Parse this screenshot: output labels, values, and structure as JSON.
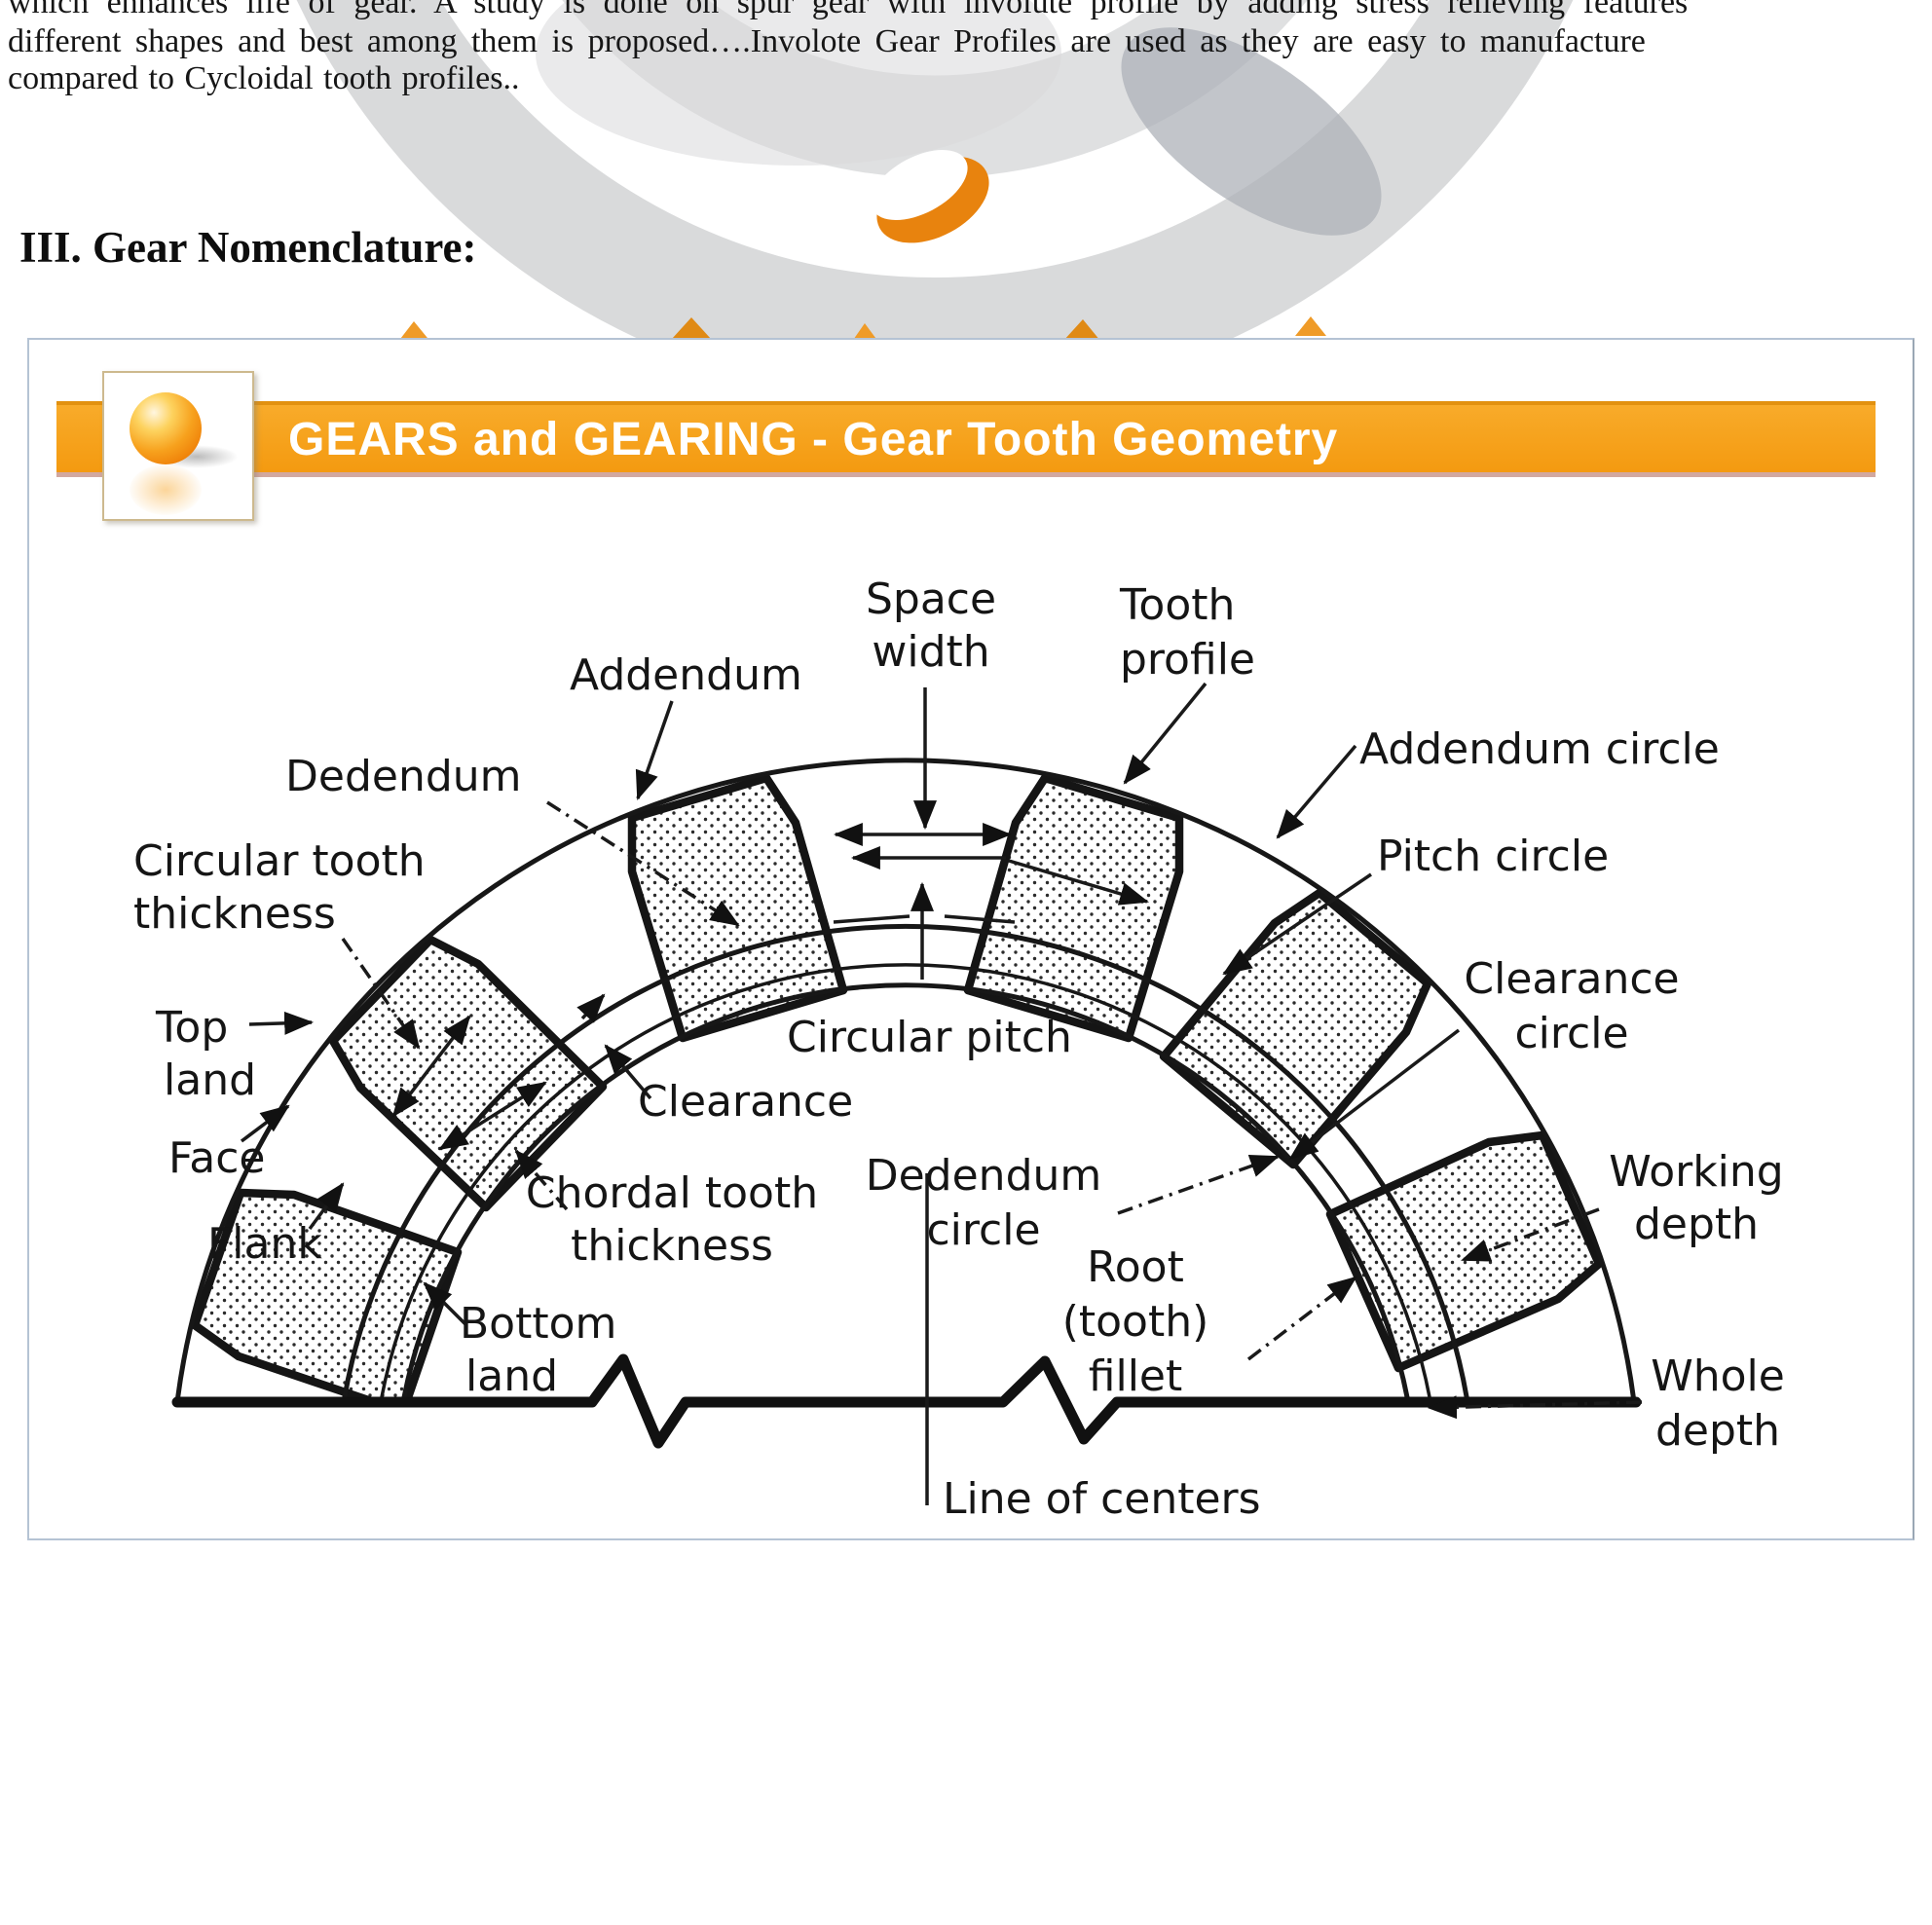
{
  "page": {
    "body_text": {
      "line1": "which enhances life of gear. A study is done on spur gear with involute profile by adding stress relieving features",
      "line2": "different shapes and best among them is proposed….Involote Gear Profiles are used as they are easy to manufacture",
      "line3": "compared to Cycloidal tooth profiles.."
    },
    "section_heading": "III. Gear Nomenclature:"
  },
  "figure": {
    "banner": {
      "title": "GEARS and GEARING - Gear Tooth Geometry",
      "bg_color": "#F6A120",
      "icon": "orange-sphere-icon"
    },
    "diagram": {
      "ink_color": "#1a1a1a",
      "labels": {
        "space_width": [
          "Space",
          "width"
        ],
        "tooth_profile": [
          "Tooth",
          "profile"
        ],
        "addendum": "Addendum",
        "dedendum": "Dedendum",
        "addendum_circle": "Addendum circle",
        "pitch_circle": "Pitch circle",
        "circular_tooth_thickness": [
          "Circular tooth",
          "thickness"
        ],
        "clearance_circle": [
          "Clearance",
          "circle"
        ],
        "top_land": [
          "Top",
          "land"
        ],
        "circular_pitch": "Circular pitch",
        "clearance": "Clearance",
        "face": "Face",
        "flank": "Flank",
        "dedendum_circle": [
          "Dedendum",
          "circle"
        ],
        "chordal_tooth_thickness": [
          "Chordal tooth",
          "thickness"
        ],
        "working_depth": [
          "Working",
          "depth"
        ],
        "whole_depth": [
          "Whole",
          "depth"
        ],
        "bottom_land": [
          "Bottom",
          "land"
        ],
        "root_tooth_fillet": [
          "Root",
          "(tooth)",
          "fillet"
        ],
        "line_of_centers": "Line of centers"
      }
    }
  }
}
